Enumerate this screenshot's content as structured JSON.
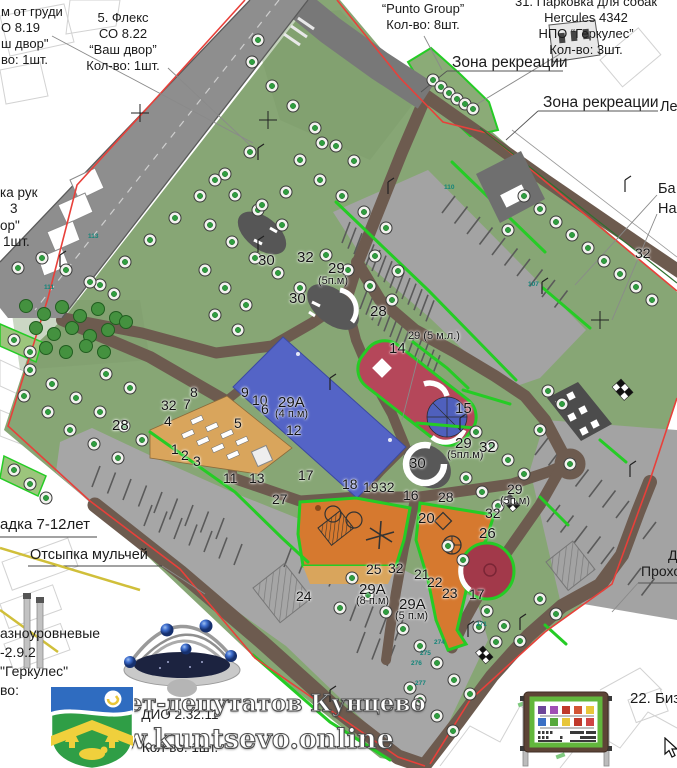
{
  "annotations": {
    "top_left_partial": {
      "lines": [
        "м от груди",
        "О 8.19",
        "ш двор\"",
        "во: 1шт."
      ]
    },
    "fleks": {
      "lines": [
        "5. Флекс",
        "СО 8.22",
        "“Ваш двор”",
        "Кол-во: 1шт."
      ]
    },
    "punto": {
      "lines": [
        "“Punto Group”",
        "Кол-во: 8шт."
      ]
    },
    "dog_parking": {
      "lines": [
        "31. Парковка для собак",
        "Hercules 4342",
        "НПО “Геркулес”",
        "Кол-во: 3шт."
      ]
    },
    "zona_1": "Зона рекреации",
    "zona_2": "Зона рекреации",
    "le_partial": "Ле",
    "ba_partial": "Ба",
    "na_partial": "На",
    "ka_ruk": {
      "lines": [
        "ка рук",
        "3",
        "ор\"",
        "1шт."
      ]
    },
    "adka": "адка 7-12лет",
    "otsypka": "Отсыпка мульчей",
    "raznour": {
      "lines": [
        "азноуровневые",
        "-2.9.2",
        "\"Геркулес\"",
        "во:"
      ]
    },
    "dio": "ДИО 2.32.11",
    "dio_qty": "Кол-во: 1шт.",
    "d_partial": "Д",
    "prokho": "Прохо",
    "bizi": "22. Бизи"
  },
  "watermark": {
    "line1": "Совет-депутатов Кунцево",
    "line2": "www.kuntsevo.online"
  },
  "map_labels": [
    {
      "t": "28",
      "x": 112,
      "y": 417,
      "s": 15
    },
    {
      "t": "30",
      "x": 258,
      "y": 252,
      "s": 15
    },
    {
      "t": "32",
      "x": 297,
      "y": 249,
      "s": 15
    },
    {
      "t": "29",
      "x": 328,
      "y": 260,
      "s": 15
    },
    {
      "t": "(5п.м)",
      "x": 318,
      "y": 275,
      "s": 11
    },
    {
      "t": "30",
      "x": 289,
      "y": 290,
      "s": 15
    },
    {
      "t": "28",
      "x": 370,
      "y": 303,
      "s": 15
    },
    {
      "t": "29 (5 м.л.)",
      "x": 408,
      "y": 330,
      "s": 11
    },
    {
      "t": "14",
      "x": 389,
      "y": 340,
      "s": 15
    },
    {
      "t": "15",
      "x": 455,
      "y": 400,
      "s": 15
    },
    {
      "t": "30",
      "x": 409,
      "y": 455,
      "s": 15
    },
    {
      "t": "29",
      "x": 455,
      "y": 435,
      "s": 15
    },
    {
      "t": "(5пл.м)",
      "x": 447,
      "y": 449,
      "s": 11
    },
    {
      "t": "32",
      "x": 479,
      "y": 439,
      "s": 15
    },
    {
      "t": "8",
      "x": 190,
      "y": 384,
      "s": 14
    },
    {
      "t": "32",
      "x": 161,
      "y": 397,
      "s": 14
    },
    {
      "t": "7",
      "x": 183,
      "y": 396,
      "s": 14
    },
    {
      "t": "4",
      "x": 164,
      "y": 413,
      "s": 14
    },
    {
      "t": "9",
      "x": 241,
      "y": 384,
      "s": 14
    },
    {
      "t": "10",
      "x": 252,
      "y": 392,
      "s": 14
    },
    {
      "t": "6",
      "x": 261,
      "y": 401,
      "s": 14
    },
    {
      "t": "5",
      "x": 234,
      "y": 415,
      "s": 14
    },
    {
      "t": "29А",
      "x": 278,
      "y": 394,
      "s": 15
    },
    {
      "t": "(4 п.м)",
      "x": 275,
      "y": 408,
      "s": 11
    },
    {
      "t": "12",
      "x": 286,
      "y": 422,
      "s": 14
    },
    {
      "t": "1",
      "x": 171,
      "y": 441,
      "s": 14
    },
    {
      "t": "2",
      "x": 181,
      "y": 447,
      "s": 14
    },
    {
      "t": "3",
      "x": 193,
      "y": 453,
      "s": 14
    },
    {
      "t": "11",
      "x": 223,
      "y": 470,
      "s": 14
    },
    {
      "t": "13",
      "x": 249,
      "y": 470,
      "s": 14
    },
    {
      "t": "17",
      "x": 298,
      "y": 467,
      "s": 14
    },
    {
      "t": "18",
      "x": 342,
      "y": 476,
      "s": 14
    },
    {
      "t": "19",
      "x": 363,
      "y": 479,
      "s": 14
    },
    {
      "t": "32",
      "x": 379,
      "y": 479,
      "s": 14
    },
    {
      "t": "16",
      "x": 403,
      "y": 487,
      "s": 14
    },
    {
      "t": "28",
      "x": 438,
      "y": 489,
      "s": 14
    },
    {
      "t": "29",
      "x": 507,
      "y": 481,
      "s": 14
    },
    {
      "t": "(5п.м)",
      "x": 500,
      "y": 495,
      "s": 11
    },
    {
      "t": "20",
      "x": 418,
      "y": 510,
      "s": 15
    },
    {
      "t": "32",
      "x": 485,
      "y": 505,
      "s": 14
    },
    {
      "t": "26",
      "x": 479,
      "y": 525,
      "s": 15
    },
    {
      "t": "27",
      "x": 272,
      "y": 491,
      "s": 14
    },
    {
      "t": "25",
      "x": 366,
      "y": 561,
      "s": 14
    },
    {
      "t": "32",
      "x": 388,
      "y": 560,
      "s": 14
    },
    {
      "t": "21",
      "x": 414,
      "y": 566,
      "s": 14
    },
    {
      "t": "22",
      "x": 427,
      "y": 574,
      "s": 14
    },
    {
      "t": "23",
      "x": 442,
      "y": 585,
      "s": 14
    },
    {
      "t": "17",
      "x": 469,
      "y": 586,
      "s": 14
    },
    {
      "t": "24",
      "x": 296,
      "y": 588,
      "s": 14
    },
    {
      "t": "29А",
      "x": 359,
      "y": 581,
      "s": 15
    },
    {
      "t": "(8 п.м)",
      "x": 356,
      "y": 595,
      "s": 11
    },
    {
      "t": "29А",
      "x": 399,
      "y": 596,
      "s": 15
    },
    {
      "t": "(5 п.м)",
      "x": 395,
      "y": 610,
      "s": 11
    },
    {
      "t": "32",
      "x": 635,
      "y": 245,
      "s": 14
    }
  ],
  "tree_tags": [
    {
      "t": "110",
      "x": 444,
      "y": 184
    },
    {
      "t": "107",
      "x": 528,
      "y": 281
    },
    {
      "t": "113",
      "x": 88,
      "y": 233
    },
    {
      "t": "111",
      "x": 44,
      "y": 284
    },
    {
      "t": "271",
      "x": 476,
      "y": 621
    },
    {
      "t": "274",
      "x": 434,
      "y": 639
    },
    {
      "t": "275",
      "x": 420,
      "y": 650
    },
    {
      "t": "276",
      "x": 411,
      "y": 660
    },
    {
      "t": "277",
      "x": 415,
      "y": 680
    }
  ],
  "map_points": {
    "trees": [
      [
        258,
        40
      ],
      [
        252,
        62
      ],
      [
        272,
        86
      ],
      [
        293,
        106
      ],
      [
        315,
        128
      ],
      [
        336,
        146
      ],
      [
        354,
        161
      ],
      [
        322,
        143
      ],
      [
        300,
        160
      ],
      [
        433,
        80
      ],
      [
        441,
        87
      ],
      [
        449,
        93
      ],
      [
        457,
        99
      ],
      [
        465,
        104
      ],
      [
        473,
        109
      ],
      [
        100,
        285
      ],
      [
        125,
        262
      ],
      [
        150,
        240
      ],
      [
        175,
        218
      ],
      [
        200,
        196
      ],
      [
        225,
        174
      ],
      [
        250,
        152
      ],
      [
        215,
        180
      ],
      [
        235,
        195
      ],
      [
        258,
        210
      ],
      [
        282,
        225
      ],
      [
        262,
        205
      ],
      [
        286,
        192
      ],
      [
        210,
        225
      ],
      [
        232,
        242
      ],
      [
        255,
        258
      ],
      [
        278,
        273
      ],
      [
        300,
        288
      ],
      [
        205,
        270
      ],
      [
        225,
        288
      ],
      [
        246,
        305
      ],
      [
        215,
        315
      ],
      [
        238,
        330
      ],
      [
        320,
        180
      ],
      [
        342,
        196
      ],
      [
        364,
        212
      ],
      [
        386,
        228
      ],
      [
        326,
        255
      ],
      [
        348,
        270
      ],
      [
        370,
        286
      ],
      [
        392,
        300
      ],
      [
        375,
        256
      ],
      [
        398,
        271
      ],
      [
        18,
        268
      ],
      [
        42,
        258
      ],
      [
        66,
        270
      ],
      [
        90,
        282
      ],
      [
        114,
        294
      ],
      [
        30,
        370
      ],
      [
        52,
        384
      ],
      [
        76,
        398
      ],
      [
        100,
        412
      ],
      [
        124,
        426
      ],
      [
        48,
        412
      ],
      [
        24,
        396
      ],
      [
        70,
        430
      ],
      [
        94,
        444
      ],
      [
        118,
        458
      ],
      [
        142,
        440
      ],
      [
        106,
        374
      ],
      [
        130,
        388
      ],
      [
        14,
        340
      ],
      [
        30,
        352
      ],
      [
        14,
        470
      ],
      [
        30,
        484
      ],
      [
        46,
        498
      ],
      [
        524,
        196
      ],
      [
        540,
        209
      ],
      [
        556,
        222
      ],
      [
        572,
        235
      ],
      [
        588,
        248
      ],
      [
        604,
        261
      ],
      [
        620,
        274
      ],
      [
        636,
        287
      ],
      [
        508,
        230
      ],
      [
        652,
        300
      ],
      [
        476,
        432
      ],
      [
        492,
        446
      ],
      [
        508,
        460
      ],
      [
        524,
        474
      ],
      [
        466,
        478
      ],
      [
        482,
        492
      ],
      [
        498,
        506
      ],
      [
        548,
        391
      ],
      [
        562,
        404
      ],
      [
        540,
        430
      ],
      [
        570,
        464
      ],
      [
        352,
        578
      ],
      [
        340,
        608
      ],
      [
        368,
        595
      ],
      [
        386,
        612
      ],
      [
        403,
        629
      ],
      [
        420,
        646
      ],
      [
        437,
        663
      ],
      [
        454,
        680
      ],
      [
        470,
        694
      ],
      [
        487,
        611
      ],
      [
        504,
        626
      ],
      [
        520,
        641
      ],
      [
        479,
        627
      ],
      [
        496,
        642
      ],
      [
        540,
        599
      ],
      [
        556,
        614
      ],
      [
        420,
        700
      ],
      [
        437,
        716
      ],
      [
        453,
        731
      ],
      [
        410,
        688
      ],
      [
        463,
        560
      ],
      [
        448,
        546
      ]
    ],
    "bushes": [
      [
        26,
        306
      ],
      [
        44,
        314
      ],
      [
        62,
        307
      ],
      [
        80,
        316
      ],
      [
        98,
        309
      ],
      [
        116,
        318
      ],
      [
        36,
        328
      ],
      [
        54,
        334
      ],
      [
        72,
        328
      ],
      [
        90,
        336
      ],
      [
        108,
        330
      ],
      [
        126,
        322
      ],
      [
        46,
        348
      ],
      [
        66,
        352
      ],
      [
        86,
        346
      ],
      [
        104,
        352
      ]
    ]
  },
  "colors": {
    "park_green": "#87a675",
    "path_brown": "#6d5b4f",
    "road_gray": "#8e8e8e",
    "parking_gray": "#a3a3a3",
    "field_blue": "#5464c6",
    "court_red": "#b5475a",
    "dark_red": "#a2394a",
    "playground_orange": "#d6792f",
    "sand_tan": "#d9a55c",
    "zone_border_green": "#25cc25",
    "boundary_red": "#e8403a"
  }
}
